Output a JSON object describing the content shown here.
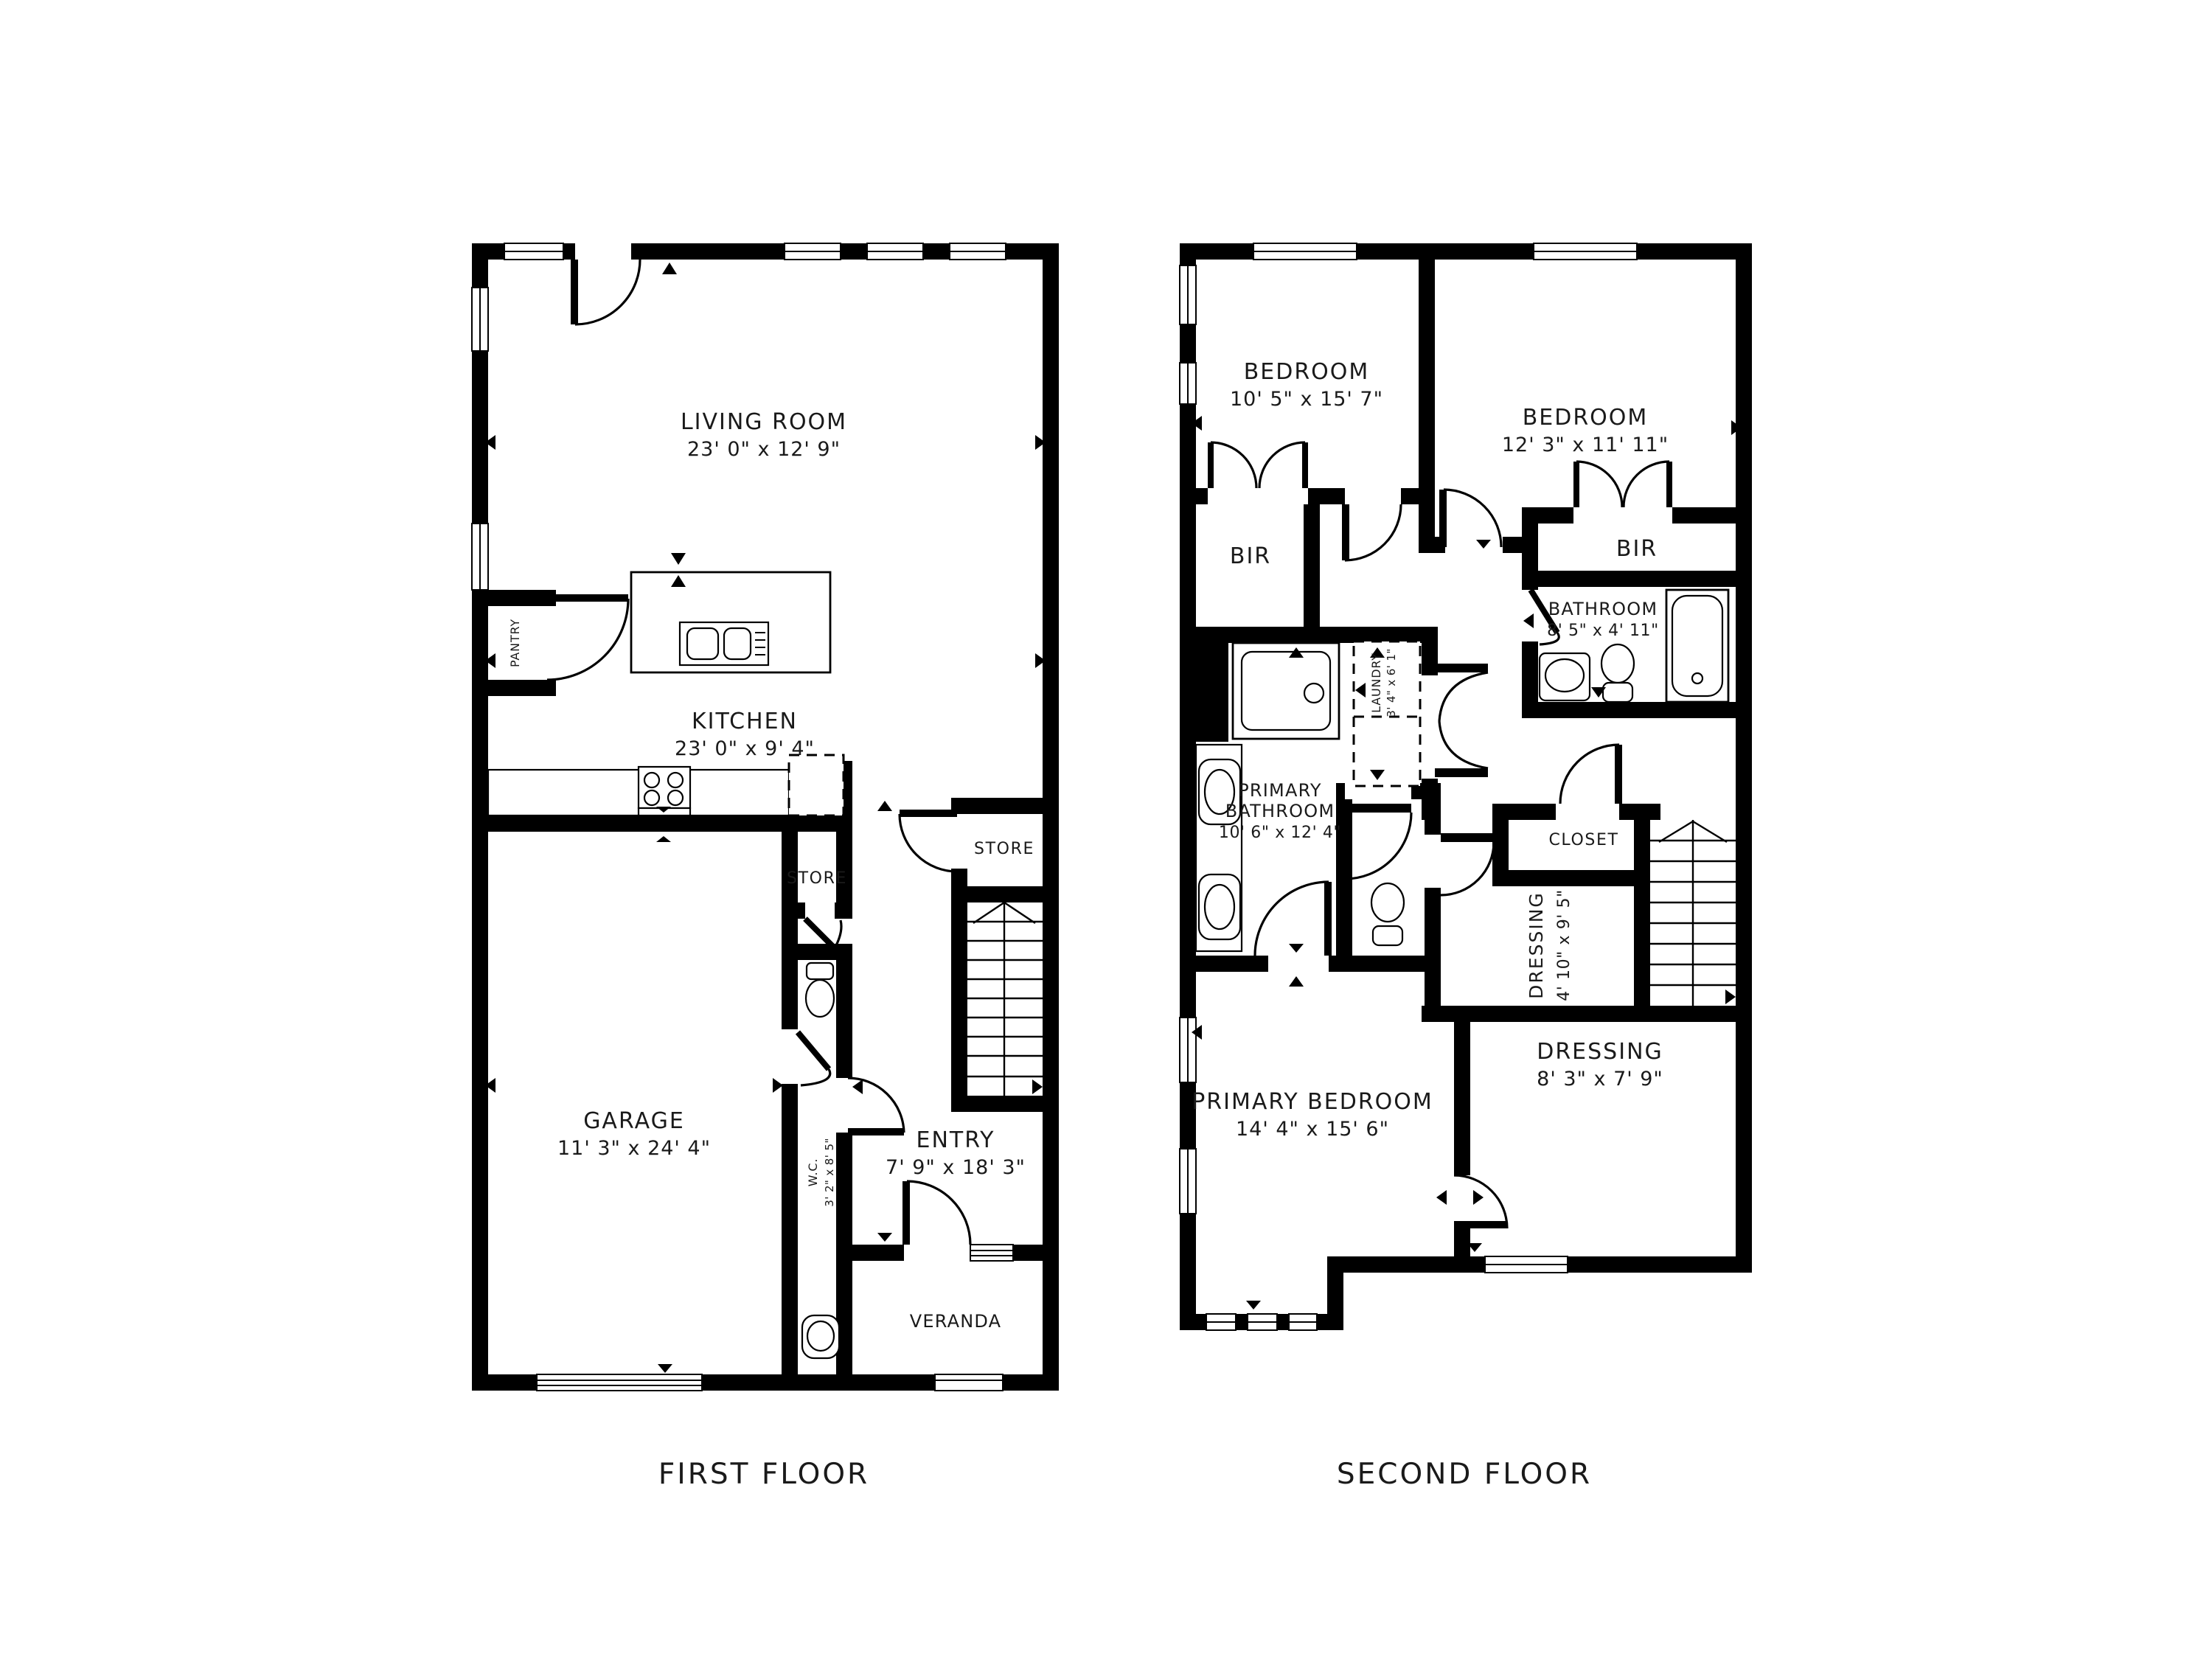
{
  "page": {
    "background": "#ffffff",
    "wall_color": "#000000",
    "text_color": "#1a1a1a"
  },
  "first": {
    "title": "FIRST FLOOR",
    "living": {
      "name": "LIVING ROOM",
      "dims": "23' 0\" x 12' 9\""
    },
    "kitchen": {
      "name": "KITCHEN",
      "dims": "23' 0\" x 9' 4\""
    },
    "pantry": {
      "name": "PANTRY"
    },
    "store_inner": {
      "name": "STORE"
    },
    "store_outer": {
      "name": "STORE"
    },
    "garage": {
      "name": "GARAGE",
      "dims": "11' 3\" x 24' 4\""
    },
    "wc": {
      "name": "W.C.",
      "dims": "3' 2\" x 8' 5\""
    },
    "entry": {
      "name": "ENTRY",
      "dims": "7' 9\" x 18' 3\""
    },
    "veranda": {
      "name": "VERANDA"
    },
    "fixtures": [
      "kitchen-island-double-sink",
      "stove-4-burner",
      "refrigerator-dashed",
      "toilet",
      "washbasin",
      "staircase-up",
      "garage-door-band",
      "entry-threshold"
    ]
  },
  "second": {
    "title": "SECOND FLOOR",
    "bedroom_left": {
      "name": "BEDROOM",
      "dims": "10' 5\" x 15' 7\""
    },
    "bedroom_right": {
      "name": "BEDROOM",
      "dims": "12' 3\" x 11' 11\""
    },
    "bir_left": {
      "name": "BIR"
    },
    "bir_right": {
      "name": "BIR"
    },
    "bathroom": {
      "name": "BATHROOM",
      "dims": "8' 5\" x 4' 11\""
    },
    "laundry": {
      "name": "LAUNDRY",
      "dims": "3' 4\" x 6' 1\""
    },
    "primary_bathroom": {
      "name_line1": "PRIMARY",
      "name_line2": "BATHROOM",
      "dims": "10' 6\" x 12' 4\""
    },
    "closet": {
      "name": "CLOSET"
    },
    "dressing_small": {
      "name": "DRESSING",
      "dims": "4' 10\" x 9' 5\""
    },
    "primary_bedroom": {
      "name": "PRIMARY BEDROOM",
      "dims": "14' 4\" x 15' 6\""
    },
    "dressing_large": {
      "name": "DRESSING",
      "dims": "8' 3\" x 7' 9\""
    },
    "fixtures": [
      "shower-unit",
      "laundry-dashed",
      "vanity-two-sinks",
      "toilet",
      "toilet",
      "washbasin",
      "bathtub",
      "staircase-up",
      "window-bands"
    ]
  }
}
